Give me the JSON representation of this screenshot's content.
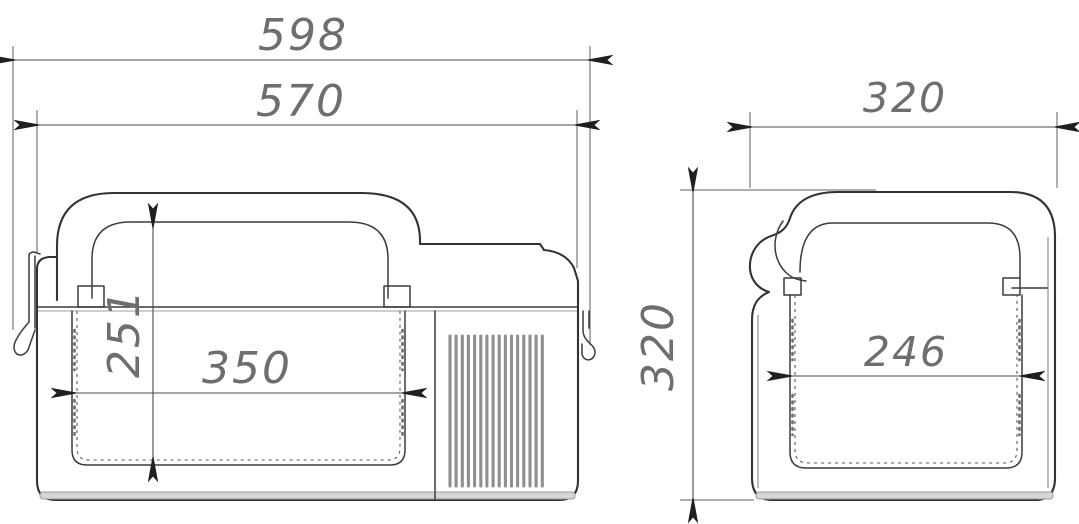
{
  "drawing": {
    "front_view": {
      "overall_width": "598",
      "lid_width": "570",
      "inner_height": "251",
      "inner_width": "350",
      "vent_slat_count": 16
    },
    "side_view": {
      "overall_depth": "320",
      "overall_height": "320",
      "inner_depth": "246"
    },
    "colors": {
      "outline": "#333333",
      "dimension_line": "#4a4a4a",
      "dimension_text": "#6e6e6e",
      "vent_slat": "#8f8f8f",
      "base_shading": "#d6d6d6"
    }
  }
}
